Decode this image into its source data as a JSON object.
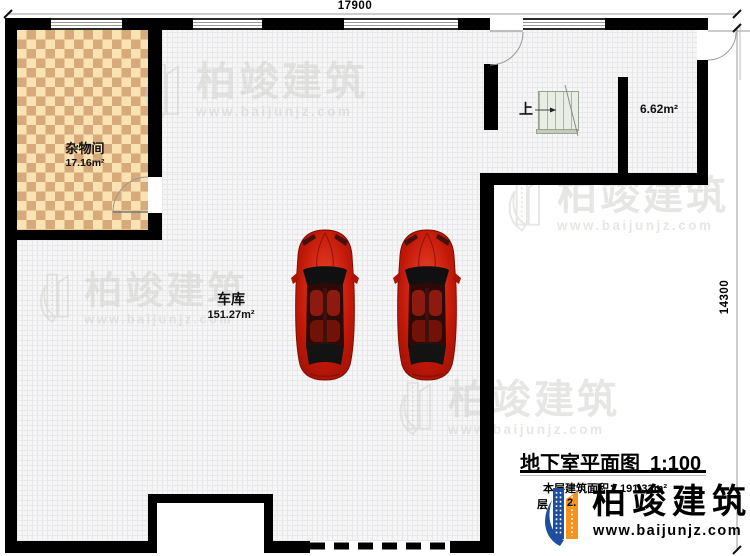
{
  "dimensions": {
    "top": "17900",
    "right": "14300"
  },
  "rooms": {
    "storage": {
      "name": "杂物间",
      "area": "17.16m²"
    },
    "garage": {
      "name": "车库",
      "area": "151.27m²"
    },
    "small_room": {
      "area": "6.62m²"
    },
    "stair": {
      "direction_label": "上"
    }
  },
  "title_block": {
    "title": "地下室平面图",
    "scale": "1:100",
    "area_label": "本层建筑面积：191.33m²",
    "fragment_left": "层",
    "fragment_right": "2."
  },
  "brand": {
    "name": "柏竣建筑",
    "website": "www.baijunjz.com"
  },
  "watermark": {
    "name": "柏竣建筑",
    "website": "www.baijunjz.com"
  },
  "icons": {
    "logo": "building-logo-icon",
    "watermark": "building-watermark-icon",
    "car": "car-top-view"
  },
  "colors": {
    "wall": "#000000",
    "floor_bg": "#f6f6f7",
    "floor_grid": "#e8e8eb",
    "checker_light": "#fae2b2",
    "checker_dark": "#d7aa7b",
    "stair_fill": "#e9eee5",
    "stair_line": "#aeb6a9",
    "car_red": "#c21808",
    "logo_blue": "#1d4f9e",
    "logo_orange": "#f6921e",
    "watermark": "#cfcfca",
    "ink": "#1a1a1a"
  }
}
